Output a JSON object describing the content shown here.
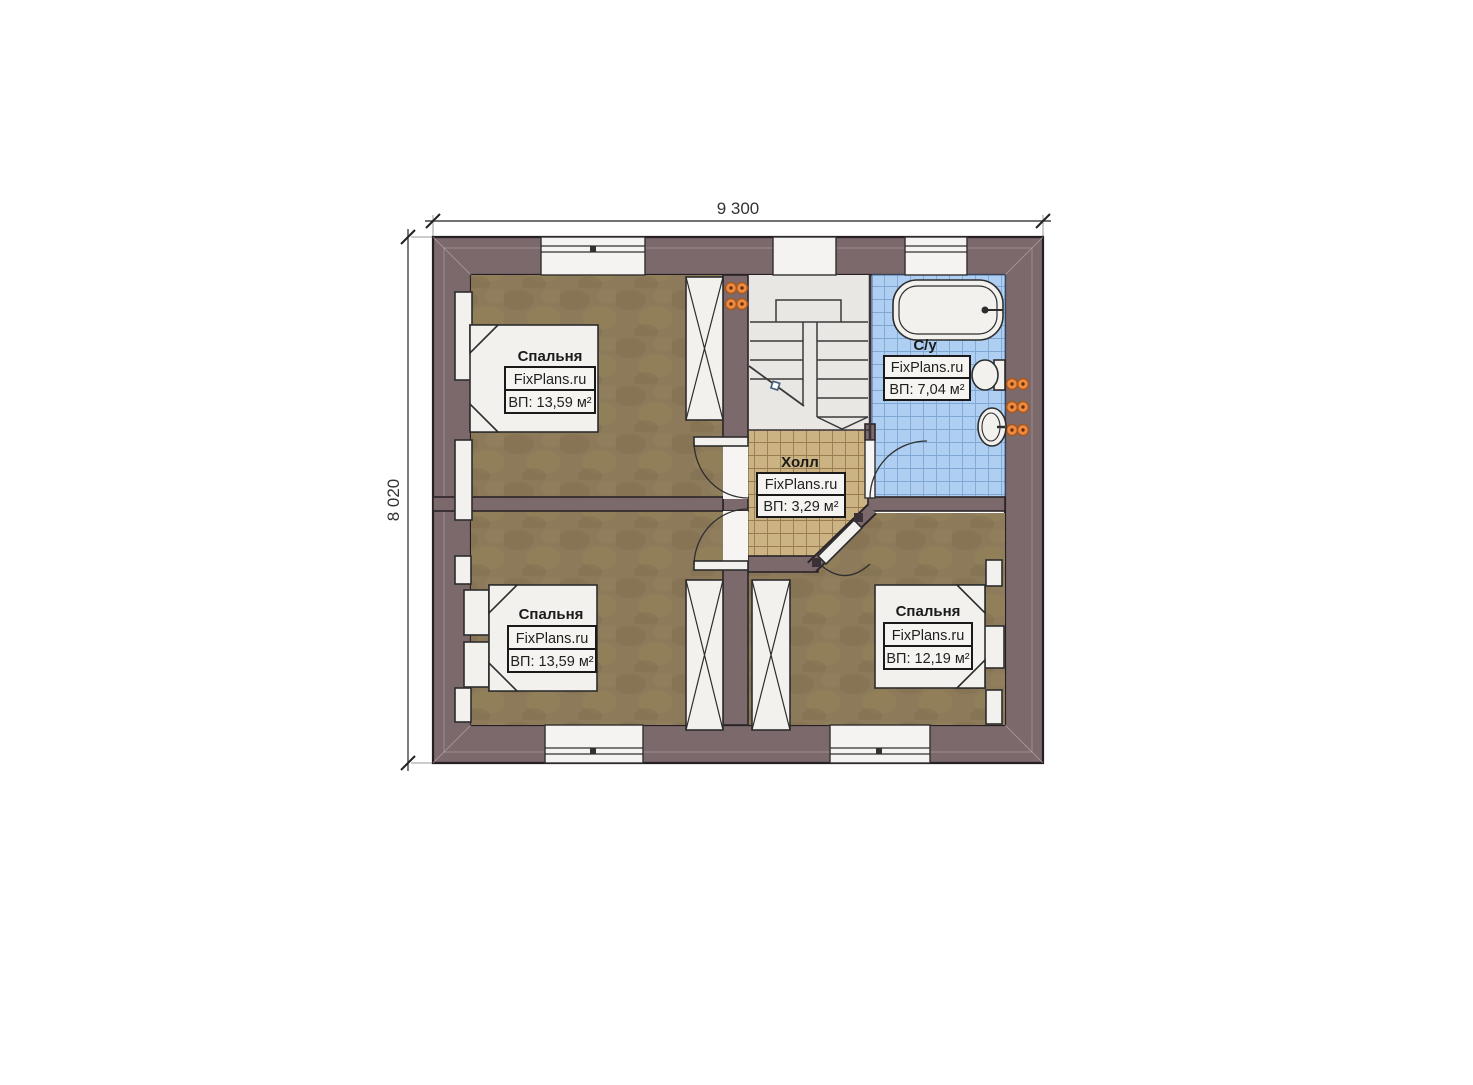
{
  "dimensions": {
    "top": "9 300",
    "left": "8 020"
  },
  "rooms": {
    "bedroom_tl": {
      "name": "Спальня",
      "brand": "FixPlans.ru",
      "area": "ВП: 13,59 м²"
    },
    "bedroom_bl": {
      "name": "Спальня",
      "brand": "FixPlans.ru",
      "area": "ВП: 13,59 м²"
    },
    "bedroom_br": {
      "name": "Спальня",
      "brand": "FixPlans.ru",
      "area": "ВП: 12,19 м²"
    },
    "bathroom": {
      "name": "С/у",
      "brand": "FixPlans.ru",
      "area": "ВП: 7,04 м²"
    },
    "hall": {
      "name": "Холл",
      "brand": "FixPlans.ru",
      "area": "ВП: 3,29 м²"
    }
  },
  "colors": {
    "wall": "#7b696c",
    "wood_floor": "#8c7a5a",
    "hall_tile": "#cbb383",
    "bath_tile": "#aecff2",
    "stair_floor": "#e8e7e4",
    "radiator": "#ee8a42"
  }
}
